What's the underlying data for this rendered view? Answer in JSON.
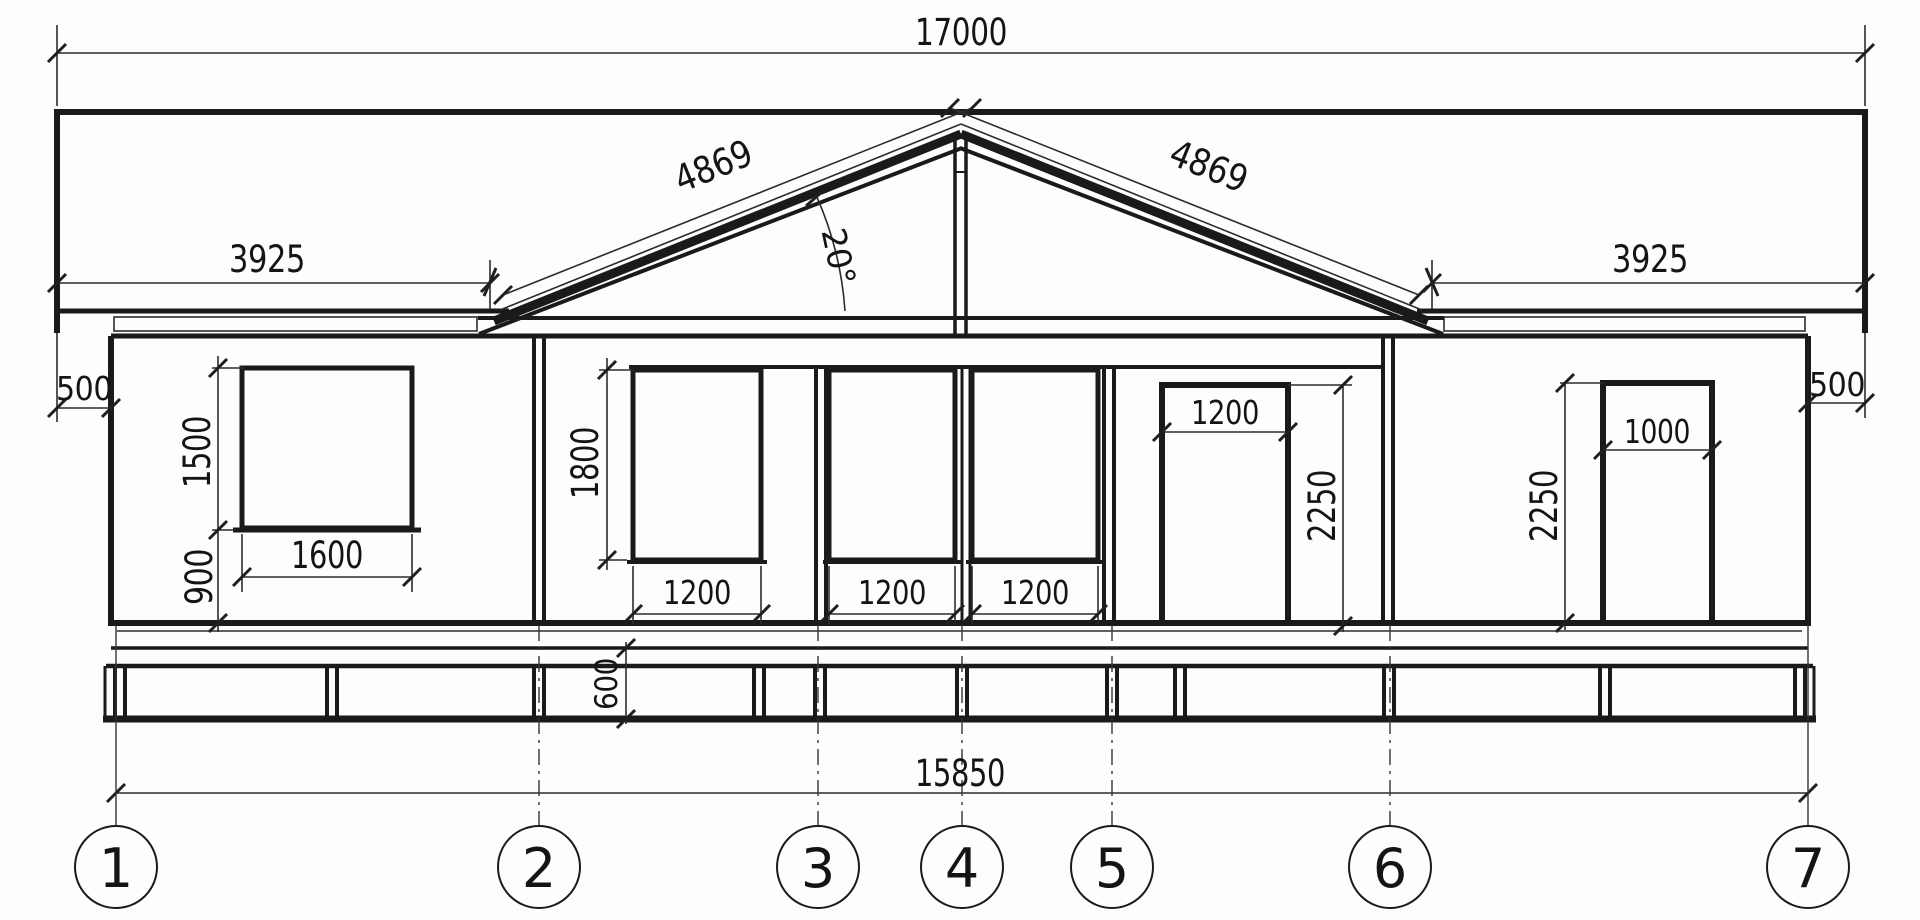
{
  "drawing": {
    "title": "house-front-elevation",
    "dims": {
      "total_width": "17000",
      "eave_left": "3925",
      "eave_right": "3925",
      "slope_left": "4869",
      "slope_right": "4869",
      "roof_angle": "20°",
      "overhang_left": "500",
      "overhang_right": "500",
      "window1": {
        "width": "1600",
        "height": "1500",
        "sill": "900"
      },
      "center_windows": {
        "height": "1800",
        "widths": [
          "1200",
          "1200",
          "1200"
        ]
      },
      "door_a": {
        "width": "1200",
        "height": "2250"
      },
      "door_b": {
        "width": "1000",
        "height": "2250"
      },
      "plinth_height": "600",
      "axis_span": "15850"
    },
    "axes": [
      "1",
      "2",
      "3",
      "4",
      "5",
      "6",
      "7"
    ]
  }
}
